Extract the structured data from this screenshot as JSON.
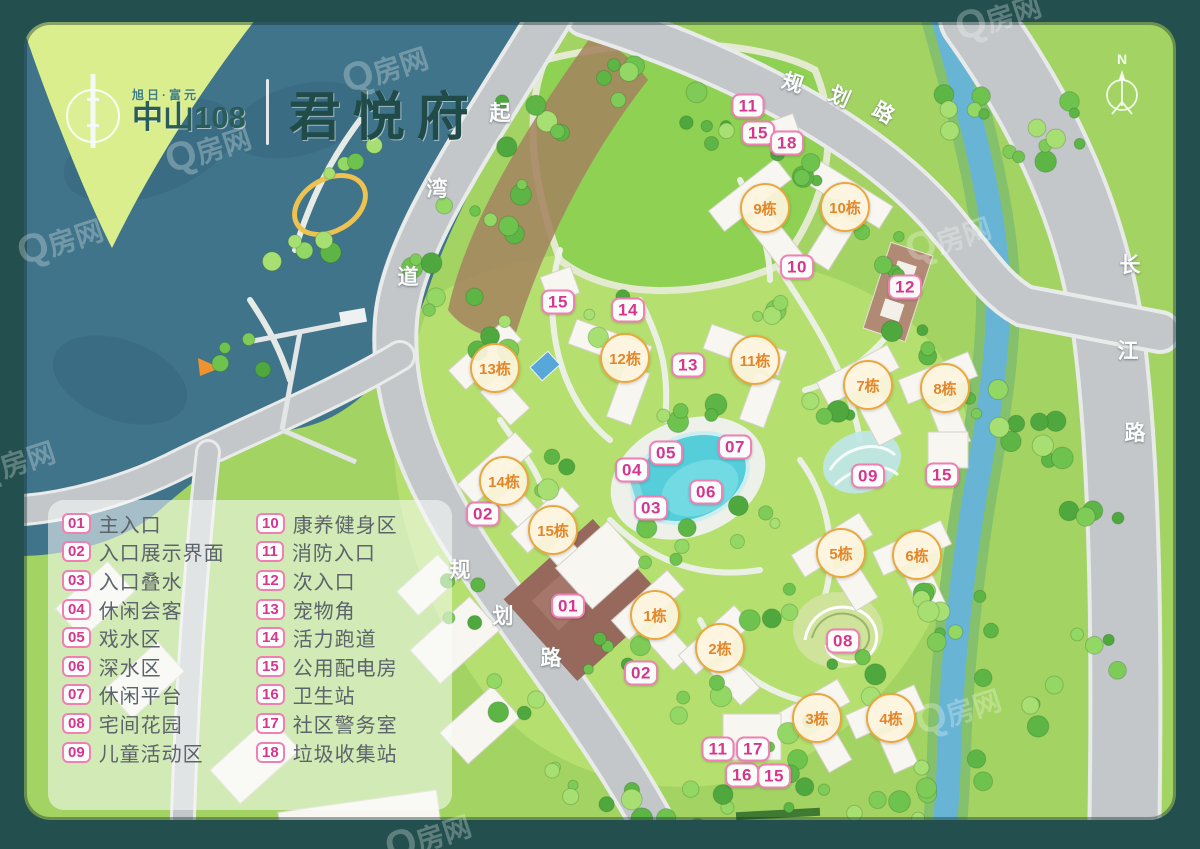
{
  "brand": {
    "tagline": "旭日·富元",
    "name": "中山108",
    "project": "君悦府"
  },
  "compass": {
    "label": "N"
  },
  "watermark": {
    "text": "Q房网"
  },
  "colors": {
    "frame": "#23504e",
    "sea": "#40748a",
    "poi_accent": "#d6368f",
    "unit_accent": "#e3862a",
    "road": "#c3c7c9",
    "pool": "#55ced9"
  },
  "legend": {
    "items": [
      {
        "num": "01",
        "label": "主入口"
      },
      {
        "num": "02",
        "label": "入口展示界面"
      },
      {
        "num": "03",
        "label": "入口叠水"
      },
      {
        "num": "04",
        "label": "休闲会客"
      },
      {
        "num": "05",
        "label": "戏水区"
      },
      {
        "num": "06",
        "label": "深水区"
      },
      {
        "num": "07",
        "label": "休闲平台"
      },
      {
        "num": "08",
        "label": "宅间花园"
      },
      {
        "num": "09",
        "label": "儿童活动区"
      },
      {
        "num": "10",
        "label": "康养健身区"
      },
      {
        "num": "11",
        "label": "消防入口"
      },
      {
        "num": "12",
        "label": "次入口"
      },
      {
        "num": "13",
        "label": "宠物角"
      },
      {
        "num": "14",
        "label": "活力跑道"
      },
      {
        "num": "15",
        "label": "公用配电房"
      },
      {
        "num": "16",
        "label": "卫生站"
      },
      {
        "num": "17",
        "label": "社区警务室"
      },
      {
        "num": "18",
        "label": "垃圾收集站"
      }
    ]
  },
  "map": {
    "road_labels": [
      {
        "name": "planned-road-north",
        "chars": [
          {
            "t": "规",
            "x": 793,
            "y": 82,
            "r": 18
          },
          {
            "t": "划",
            "x": 840,
            "y": 96,
            "r": 24
          },
          {
            "t": "路",
            "x": 884,
            "y": 112,
            "r": 30
          }
        ]
      },
      {
        "name": "qiwan-road",
        "chars": [
          {
            "t": "起",
            "x": 500,
            "y": 112,
            "r": 0
          },
          {
            "t": "湾",
            "x": 437,
            "y": 188,
            "r": 0
          },
          {
            "t": "道",
            "x": 408,
            "y": 276,
            "r": 0
          }
        ]
      },
      {
        "name": "changjiang-road",
        "chars": [
          {
            "t": "长",
            "x": 1130,
            "y": 264,
            "r": 0
          },
          {
            "t": "江",
            "x": 1128,
            "y": 350,
            "r": 0
          },
          {
            "t": "路",
            "x": 1135,
            "y": 432,
            "r": 0
          }
        ]
      },
      {
        "name": "planned-road-southwest",
        "chars": [
          {
            "t": "规",
            "x": 460,
            "y": 569,
            "r": 0
          },
          {
            "t": "划",
            "x": 503,
            "y": 615,
            "r": 0
          },
          {
            "t": "路",
            "x": 551,
            "y": 657,
            "r": 0
          }
        ]
      }
    ],
    "unit_markers": [
      {
        "label": "1栋",
        "x": 655,
        "y": 615
      },
      {
        "label": "2栋",
        "x": 720,
        "y": 648
      },
      {
        "label": "3栋",
        "x": 817,
        "y": 718
      },
      {
        "label": "4栋",
        "x": 891,
        "y": 718
      },
      {
        "label": "5栋",
        "x": 841,
        "y": 553
      },
      {
        "label": "6栋",
        "x": 917,
        "y": 555
      },
      {
        "label": "7栋",
        "x": 868,
        "y": 385
      },
      {
        "label": "8栋",
        "x": 945,
        "y": 388
      },
      {
        "label": "9栋",
        "x": 765,
        "y": 208
      },
      {
        "label": "10栋",
        "x": 845,
        "y": 207
      },
      {
        "label": "11栋",
        "x": 755,
        "y": 360
      },
      {
        "label": "12栋",
        "x": 625,
        "y": 358
      },
      {
        "label": "13栋",
        "x": 495,
        "y": 368
      },
      {
        "label": "14栋",
        "x": 504,
        "y": 481
      },
      {
        "label": "15栋",
        "x": 553,
        "y": 530
      }
    ],
    "poi_markers": [
      {
        "label": "01",
        "x": 568,
        "y": 606
      },
      {
        "label": "02",
        "x": 483,
        "y": 514
      },
      {
        "label": "02",
        "x": 641,
        "y": 673
      },
      {
        "label": "03",
        "x": 651,
        "y": 508
      },
      {
        "label": "04",
        "x": 632,
        "y": 470
      },
      {
        "label": "05",
        "x": 666,
        "y": 453
      },
      {
        "label": "06",
        "x": 706,
        "y": 492
      },
      {
        "label": "07",
        "x": 735,
        "y": 447
      },
      {
        "label": "08",
        "x": 843,
        "y": 641
      },
      {
        "label": "09",
        "x": 868,
        "y": 476
      },
      {
        "label": "10",
        "x": 797,
        "y": 267
      },
      {
        "label": "11",
        "x": 748,
        "y": 106
      },
      {
        "label": "11",
        "x": 718,
        "y": 749
      },
      {
        "label": "12",
        "x": 905,
        "y": 287
      },
      {
        "label": "13",
        "x": 688,
        "y": 365
      },
      {
        "label": "14",
        "x": 628,
        "y": 310
      },
      {
        "label": "15",
        "x": 758,
        "y": 133
      },
      {
        "label": "15",
        "x": 558,
        "y": 302
      },
      {
        "label": "15",
        "x": 942,
        "y": 475
      },
      {
        "label": "15",
        "x": 774,
        "y": 776
      },
      {
        "label": "16",
        "x": 742,
        "y": 775
      },
      {
        "label": "17",
        "x": 753,
        "y": 749
      },
      {
        "label": "18",
        "x": 787,
        "y": 143
      }
    ],
    "watermarks": [
      {
        "x": 385,
        "y": 68
      },
      {
        "x": 998,
        "y": 16
      },
      {
        "x": 208,
        "y": 148
      },
      {
        "x": 60,
        "y": 240
      },
      {
        "x": 948,
        "y": 238
      },
      {
        "x": 12,
        "y": 462
      },
      {
        "x": 428,
        "y": 836
      },
      {
        "x": 958,
        "y": 710
      }
    ]
  }
}
